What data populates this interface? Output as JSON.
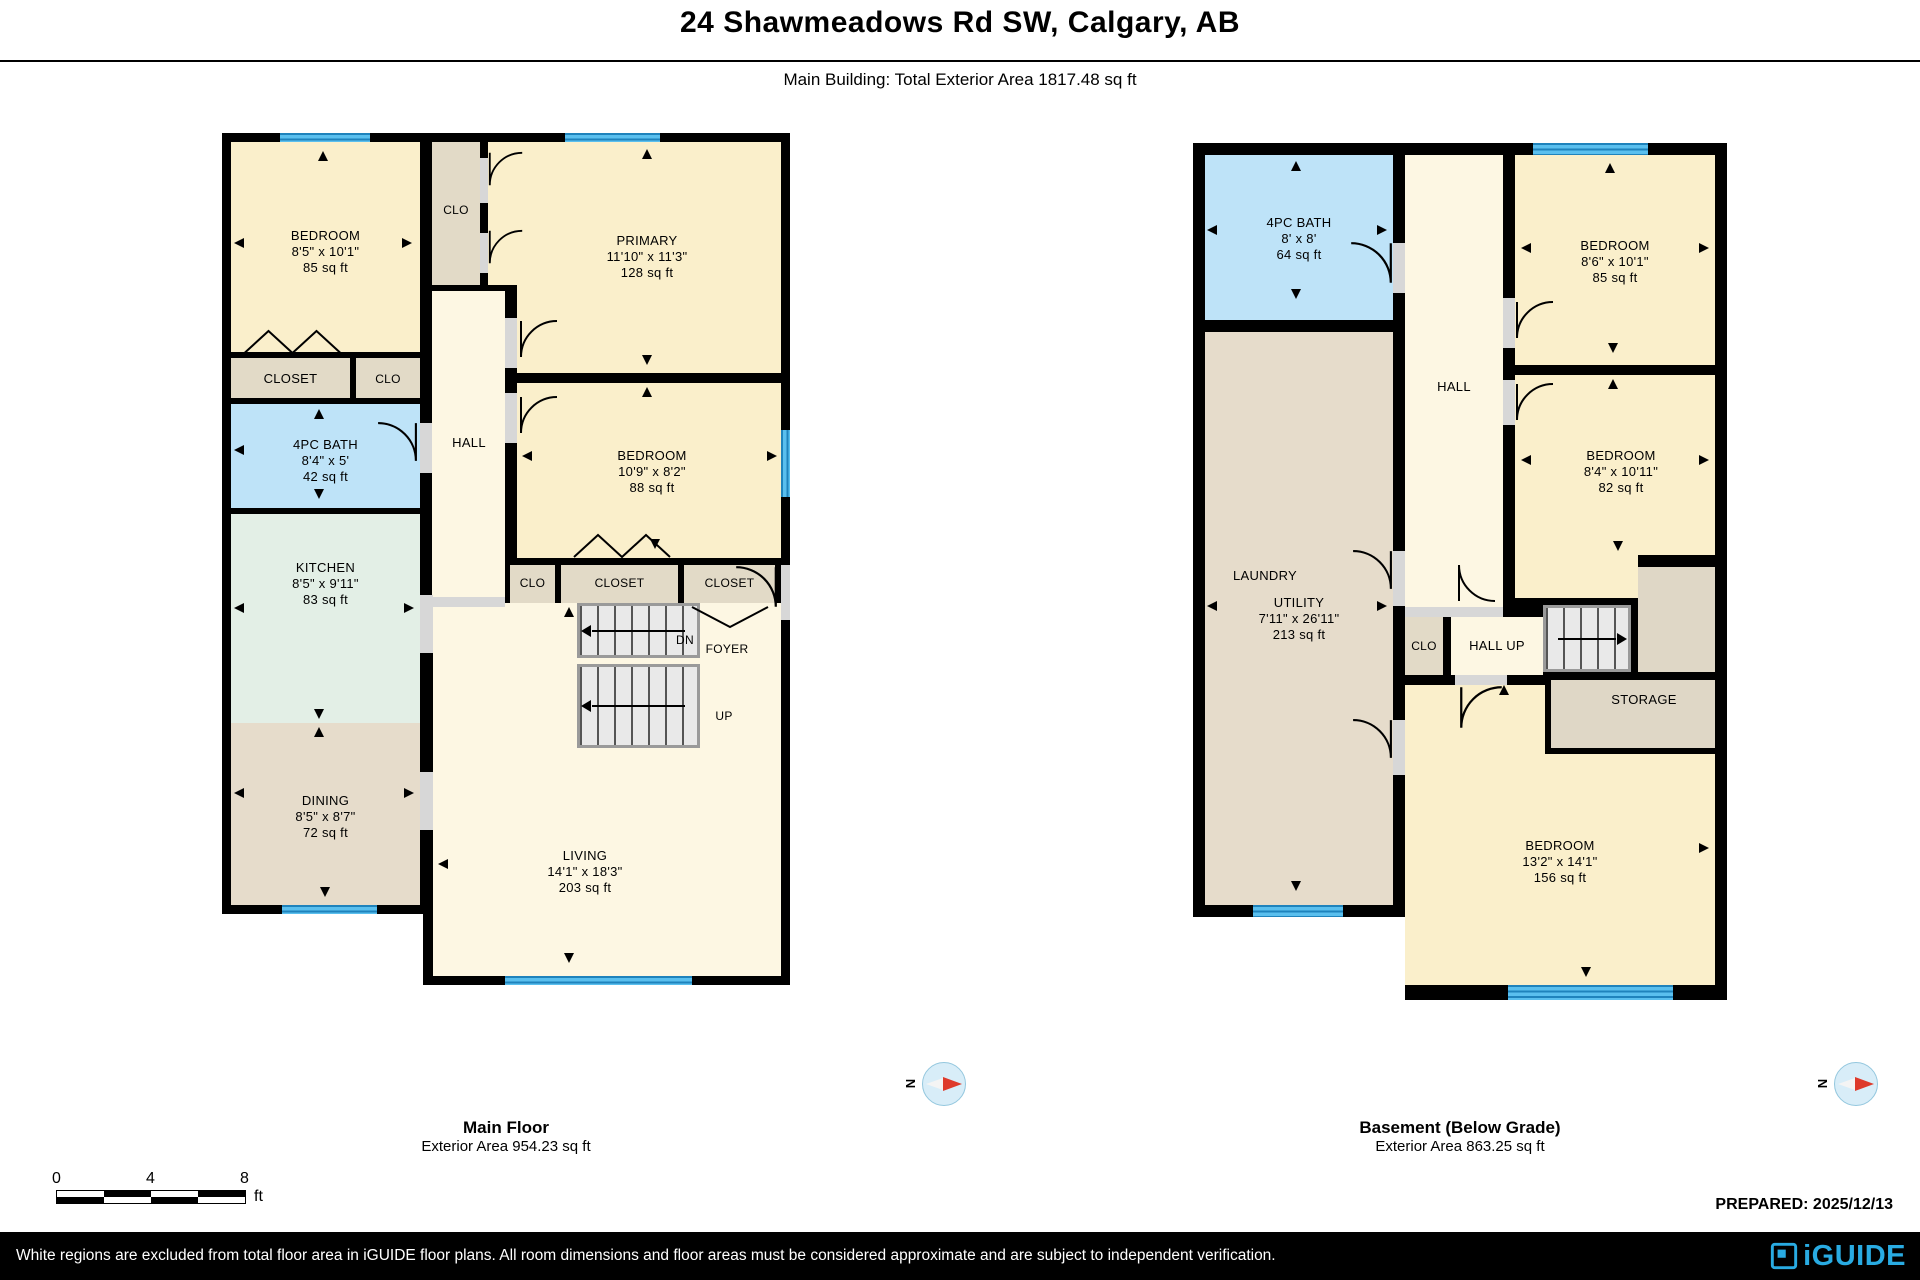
{
  "header": {
    "title": "24 Shawmeadows Rd SW, Calgary, AB",
    "subtitle": "Main Building: Total Exterior Area 1817.48 sq ft"
  },
  "icons": {
    "compass_n": "N"
  },
  "main_floor": {
    "caption_title": "Main Floor",
    "caption_area": "Exterior Area 954.23 sq ft",
    "rooms": {
      "bedroom": {
        "name": "BEDROOM",
        "dims": "8'5\" x 10'1\"",
        "area": "85 sq ft"
      },
      "clo_top": {
        "name": "CLO"
      },
      "primary": {
        "name": "PRIMARY",
        "dims": "11'10\" x 11'3\"",
        "area": "128 sq ft"
      },
      "closet_left": {
        "name": "CLOSET"
      },
      "clo_left": {
        "name": "CLO"
      },
      "bath": {
        "name": "4PC BATH",
        "dims": "8'4\" x 5'",
        "area": "42 sq ft"
      },
      "hall": {
        "name": "HALL"
      },
      "bedroom2": {
        "name": "BEDROOM",
        "dims": "10'9\" x 8'2\"",
        "area": "88 sq ft"
      },
      "kitchen": {
        "name": "KITCHEN",
        "dims": "8'5\" x 9'11\"",
        "area": "83 sq ft"
      },
      "clo_mid": {
        "name": "CLO"
      },
      "closet_mid": {
        "name": "CLOSET"
      },
      "closet_foyer": {
        "name": "CLOSET"
      },
      "dining": {
        "name": "DINING",
        "dims": "8'5\" x 8'7\"",
        "area": "72 sq ft"
      },
      "dn": "DN",
      "foyer": "FOYER",
      "up": "UP",
      "living": {
        "name": "LIVING",
        "dims": "14'1\" x 18'3\"",
        "area": "203 sq ft"
      }
    }
  },
  "basement": {
    "caption_title": "Basement (Below Grade)",
    "caption_area": "Exterior Area 863.25 sq ft",
    "rooms": {
      "bath": {
        "name": "4PC BATH",
        "dims": "8' x 8'",
        "area": "64 sq ft"
      },
      "hall": {
        "name": "HALL"
      },
      "bedroom1": {
        "name": "BEDROOM",
        "dims": "8'6\" x 10'1\"",
        "area": "85 sq ft"
      },
      "bedroom2": {
        "name": "BEDROOM",
        "dims": "8'4\" x 10'11\"",
        "area": "82 sq ft"
      },
      "laundry": {
        "name": "LAUNDRY"
      },
      "utility": {
        "name": "UTILITY",
        "dims": "7'11\" x 26'11\"",
        "area": "213 sq ft"
      },
      "clo": {
        "name": "CLO"
      },
      "hall_up": {
        "name": "HALL UP"
      },
      "storage": {
        "name": "STORAGE"
      },
      "bedroom3": {
        "name": "BEDROOM",
        "dims": "13'2\" x 14'1\"",
        "area": "156 sq ft"
      }
    }
  },
  "scale_bar": {
    "tick0": "0",
    "tick4": "4",
    "tick8": "8",
    "unit": "ft"
  },
  "prepared": "PREPARED: 2025/12/13",
  "footer": {
    "disclaimer": "White regions are excluded from total floor area in iGUIDE floor plans. All room dimensions and floor areas must be considered approximate and are subject to independent verification.",
    "brand": "iGUIDE"
  }
}
